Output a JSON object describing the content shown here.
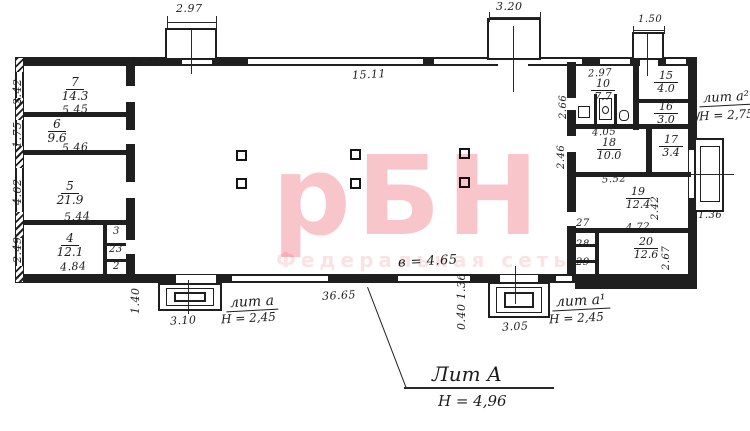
{
  "watermark": {
    "main": "рБН",
    "sub": "Федеральная сеть",
    "color": "#f2aeb5",
    "sub_color": "#f8d3d7"
  },
  "colors": {
    "ink": "#1c1c1c",
    "paper": "#ffffff"
  },
  "building": {
    "lit": "Лит А",
    "lit_height": "Н = 4,96",
    "hall_height": "в = 4.65",
    "hall_length": "36.65",
    "hall_width": "15.11",
    "top_left_width": "14.75",
    "left_height": "12.70"
  },
  "projections": {
    "left": "2.97",
    "center": "3.20",
    "right": "1.50"
  },
  "porch_left": {
    "lit": "лит а",
    "height": "Н = 2,45",
    "width": "3.10",
    "depth": "1.40"
  },
  "porch_right": {
    "lit": "лит а¹",
    "height": "Н = 2,45",
    "width": "3.05",
    "depth": "0.40 1.36"
  },
  "annex_side": {
    "lit": "лит а²",
    "height": "Н = 2,75",
    "width": "1.36"
  },
  "rooms": {
    "r7": {
      "num": "7",
      "area": "14.3",
      "width": "5.45",
      "depth": "2.42"
    },
    "r6": {
      "num": "6",
      "area": "9.6",
      "width": "5.46",
      "depth": "1.75"
    },
    "r5": {
      "num": "5",
      "area": "21.9",
      "width": "5.44",
      "depth": "4.02"
    },
    "r4": {
      "num": "4",
      "area": "12.1",
      "width": "4.84",
      "depth": "2.49"
    },
    "r3": {
      "num": "3"
    },
    "r23": {
      "num": "23"
    },
    "r2": {
      "num": "2"
    },
    "r10": {
      "num": "10",
      "area": "7.7",
      "width": "2.97",
      "depth": "2.66"
    },
    "r15": {
      "num": "15",
      "area": "4.0"
    },
    "r16": {
      "num": "16",
      "area": "3.0"
    },
    "r18": {
      "num": "18",
      "area": "10.0",
      "width": "4.05",
      "depth": "2.46"
    },
    "r17": {
      "num": "17",
      "area": "3.4"
    },
    "r19": {
      "num": "19",
      "area": "12.4",
      "width": "5.52",
      "depth": "2.42"
    },
    "r20": {
      "num": "20",
      "area": "12.6",
      "width": "4.72",
      "depth": "2.67"
    },
    "r27": {
      "num": "27"
    },
    "r28": {
      "num": "28"
    },
    "r29": {
      "num": "29"
    }
  }
}
